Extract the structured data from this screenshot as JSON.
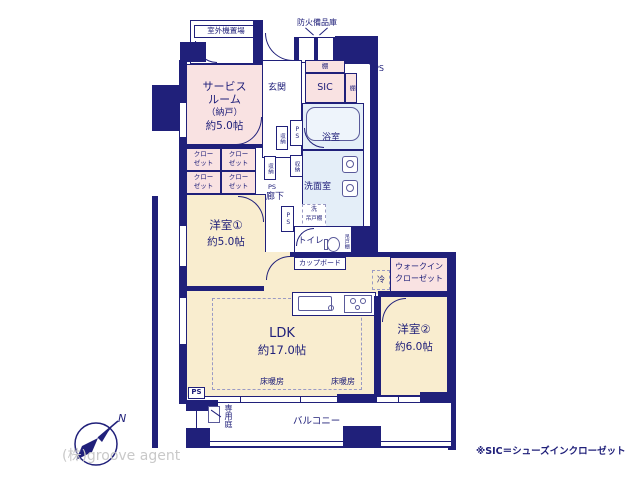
{
  "colors": {
    "wall": "#20207a",
    "room_pink": "#f9e2e2",
    "room_cream": "#f9edcf",
    "room_aqua": "#e4eef8",
    "watermark_gray": "#c9c9c9"
  },
  "plan": {
    "outdoor_unit_label": "室外機置場",
    "fire_equipment_label": "防火備品庫",
    "entrance_label": "玄関",
    "shelf_label": "棚",
    "sic_label": "SIC",
    "ps_label": "PS",
    "service_room_lines": [
      "サービス",
      "ルーム",
      "（納戸）",
      "約5.0帖"
    ],
    "storage_label": "収納",
    "bath_label": "浴室",
    "washroom_label": "洗面室",
    "corridor_label": "廊下",
    "washer_lines": [
      "洗",
      "吊戸棚"
    ],
    "toilet_label": "トイレ",
    "hanging_cupboard_label": "吊戸棚",
    "closet_lines": [
      "クロー",
      "ゼット"
    ],
    "room1": {
      "name": "洋室①",
      "size": "約5.0帖"
    },
    "cupboard_label": "カップボード",
    "fridge_label": "冷",
    "wic_lines": [
      "ウォークイン",
      "クローゼット"
    ],
    "ldk": {
      "name": "LDK",
      "size": "約17.0帖"
    },
    "room2": {
      "name": "洋室②",
      "size": "約6.0帖"
    },
    "floor_heating_label": "床暖房",
    "private_garden_label": "専用庭",
    "balcony_label": "バルコニー"
  },
  "footer": {
    "company": "(株)groove agent",
    "note": "※SIC＝シューズインクローゼット",
    "compass_n": "N"
  }
}
